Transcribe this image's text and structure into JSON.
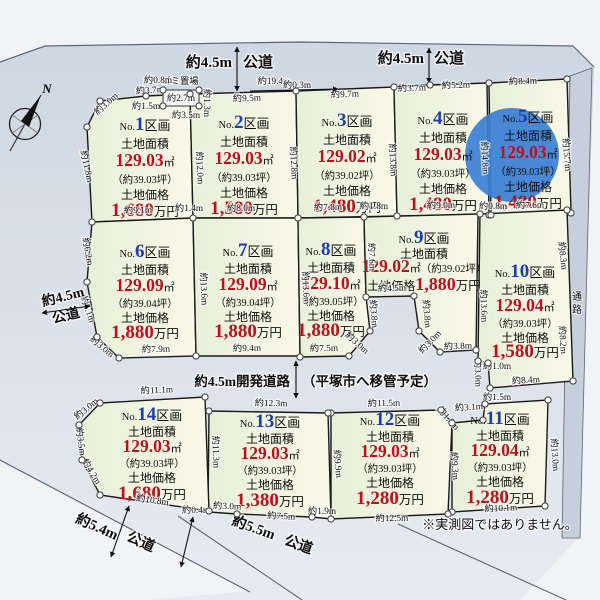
{
  "title": "分譲地区画図",
  "note": "※実測図ではありません。",
  "passage_label": "通路",
  "compass_label": "N",
  "garbage": {
    "label": "ゴミ置場",
    "box": [
      163,
      90,
      36,
      16
    ]
  },
  "colors": {
    "num_blue": "#1d3cb2",
    "price_red": "#bb101e",
    "ink": "#0f0f0f",
    "plot_fill_a": "#e7f0d8",
    "plot_fill_b": "#f9f8e7",
    "plot_stroke": "#1a1a1a",
    "road_a": "#ccd5e1",
    "road_b": "#e7ebf1",
    "outside": "#f1f3f6",
    "strip": "#c6cfdb",
    "line": "#5c6673",
    "dot_stroke": "#4a4a4a",
    "highlight": "#3b7fd4"
  },
  "shared": {
    "no_prefix": "No.",
    "kukaku": "区画",
    "area_label": "土地面積",
    "sqm": "㎡",
    "price_label": "土地価格",
    "price_unit": "万円"
  },
  "plots": [
    {
      "id": 1,
      "no": "1",
      "area": "129.03",
      "tsubo": "（約39.03坪）",
      "price": "1,680",
      "cx": 145,
      "ty": 130,
      "dys": [
        0,
        18,
        36,
        53,
        69,
        86
      ],
      "poly": [
        [
          100,
          101
        ],
        [
          146,
          96
        ],
        [
          190,
          94
        ],
        [
          193,
          218
        ],
        [
          92,
          222
        ],
        [
          87,
          127
        ]
      ]
    },
    {
      "id": 2,
      "no": "2",
      "area": "129.03",
      "tsubo": "（約39.03坪）",
      "price": "1,580",
      "cx": 244,
      "ty": 128,
      "dys": [
        0,
        18,
        36,
        53,
        69,
        86
      ],
      "poly": [
        [
          190,
          94
        ],
        [
          296,
          91
        ],
        [
          298,
          218
        ],
        [
          193,
          218
        ]
      ]
    },
    {
      "id": 3,
      "no": "3",
      "area": "129.02",
      "tsubo": "（約39.02坪）",
      "price": "1,480",
      "cx": 347,
      "ty": 126,
      "dys": [
        0,
        18,
        36,
        53,
        69,
        86
      ],
      "poly": [
        [
          296,
          91
        ],
        [
          394,
          87
        ],
        [
          397,
          216
        ],
        [
          298,
          218
        ]
      ]
    },
    {
      "id": 4,
      "no": "4",
      "area": "129.03",
      "tsubo": "（約39.03坪）",
      "price": "1,480",
      "cx": 443,
      "ty": 124,
      "dys": [
        0,
        18,
        36,
        53,
        69,
        86
      ],
      "poly": [
        [
          394,
          87
        ],
        [
          430,
          85
        ],
        [
          487,
          83
        ],
        [
          489,
          215
        ],
        [
          397,
          216
        ]
      ]
    },
    {
      "id": 5,
      "no": "5",
      "area": "129.03",
      "tsubo": "（約39.03坪）",
      "price": "1,480",
      "cx": 528,
      "ty": 122,
      "dys": [
        0,
        18,
        36,
        53,
        69,
        86
      ],
      "poly": [
        [
          489,
          83
        ],
        [
          567,
          79
        ],
        [
          571,
          213
        ],
        [
          491,
          215
        ]
      ],
      "circle": [
        512,
        155,
        47
      ]
    },
    {
      "id": 6,
      "no": "6",
      "area": "129.09",
      "tsubo": "（約39.04坪）",
      "price": "1,880",
      "cx": 145,
      "ty": 257,
      "dys": [
        0,
        17,
        34,
        50,
        65,
        81
      ],
      "poly": [
        [
          92,
          222
        ],
        [
          193,
          218
        ],
        [
          196,
          356
        ],
        [
          119,
          358
        ],
        [
          97,
          337
        ],
        [
          87,
          282
        ]
      ]
    },
    {
      "id": 7,
      "no": "7",
      "area": "129.09",
      "tsubo": "（約39.04坪）",
      "price": "1,880",
      "cx": 248,
      "ty": 256,
      "dys": [
        0,
        17,
        34,
        50,
        65,
        81
      ],
      "poly": [
        [
          193,
          218
        ],
        [
          298,
          218
        ],
        [
          300,
          356
        ],
        [
          196,
          356
        ]
      ]
    },
    {
      "id": 8,
      "no": "8",
      "area": "129.10",
      "tsubo": "（約39.05坪）",
      "price": "1,880",
      "cx": 331,
      "ty": 255,
      "dys": [
        0,
        17,
        34,
        50,
        65,
        81
      ],
      "poly": [
        [
          298,
          218
        ],
        [
          364,
          217
        ],
        [
          366,
          297
        ],
        [
          370,
          331
        ],
        [
          349,
          356
        ],
        [
          300,
          357
        ]
      ]
    },
    {
      "id": 9,
      "no": "9",
      "area": "129.02",
      "tsubo": "（約39.02坪）",
      "price": "1,880",
      "cx": 424,
      "ty": 243,
      "dys": [
        0,
        15,
        29,
        47
      ],
      "wide": true,
      "poly": [
        [
          364,
          217
        ],
        [
          478,
          214
        ],
        [
          476,
          350
        ],
        [
          440,
          352
        ],
        [
          419,
          331
        ],
        [
          414,
          296
        ],
        [
          366,
          297
        ]
      ]
    },
    {
      "id": 10,
      "no": "10",
      "area": "129.04",
      "tsubo": "（約39.03坪）",
      "price": "1,580",
      "cx": 525,
      "ty": 277,
      "dys": [
        0,
        17,
        34,
        50,
        65,
        80
      ],
      "poly": [
        [
          480,
          214
        ],
        [
          567,
          210
        ],
        [
          573,
          381
        ],
        [
          490,
          388
        ],
        [
          488,
          363
        ],
        [
          478,
          361
        ]
      ]
    },
    {
      "id": 11,
      "no": "11",
      "area": "129.04",
      "tsubo": "（約39.03坪）",
      "price": "1,280",
      "cx": 500,
      "ty": 424,
      "dys": [
        0,
        16,
        32,
        47,
        62,
        79
      ],
      "poly": [
        [
          452,
          423
        ],
        [
          483,
          420
        ],
        [
          485,
          404
        ],
        [
          548,
          400
        ],
        [
          545,
          506
        ],
        [
          452,
          512
        ]
      ]
    },
    {
      "id": 12,
      "no": "12",
      "area": "129.03",
      "tsubo": "（約39.03坪）",
      "price": "1,280",
      "cx": 390,
      "ty": 425,
      "dys": [
        0,
        16,
        32,
        47,
        62,
        79
      ],
      "poly": [
        [
          331,
          413
        ],
        [
          441,
          410
        ],
        [
          452,
          423
        ],
        [
          448,
          514
        ],
        [
          331,
          519
        ]
      ]
    },
    {
      "id": 13,
      "no": "13",
      "area": "129.03",
      "tsubo": "（約39.03坪）",
      "price": "1,380",
      "cx": 270,
      "ty": 427,
      "dys": [
        0,
        16,
        32,
        47,
        62,
        79
      ],
      "poly": [
        [
          209,
          411
        ],
        [
          328,
          413
        ],
        [
          331,
          519
        ],
        [
          312,
          517
        ],
        [
          237,
          514
        ],
        [
          208,
          512
        ]
      ]
    },
    {
      "id": 14,
      "no": "14",
      "area": "129.03",
      "tsubo": "（約39.03坪）",
      "price": "1,680",
      "cx": 152,
      "ty": 420,
      "dys": [
        0,
        16,
        32,
        47,
        62,
        79
      ],
      "poly": [
        [
          100,
          403
        ],
        [
          205,
          397
        ],
        [
          209,
          511
        ],
        [
          100,
          495
        ],
        [
          82,
          460
        ],
        [
          79,
          425
        ]
      ]
    }
  ],
  "dims": [
    {
      "t": "約0.8m",
      "x": 158,
      "y": 83,
      "r": 0
    },
    {
      "t": "約19.4m",
      "x": 274,
      "y": 84,
      "r": 0
    },
    {
      "t": "約2.7m",
      "x": 181,
      "y": 101,
      "r": 0
    },
    {
      "t": "約3.5m",
      "x": 186,
      "y": 118,
      "r": 0
    },
    {
      "t": "約1.3m",
      "x": 204,
      "y": 103,
      "r": 90
    },
    {
      "t": "約3.0m",
      "x": 108,
      "y": 106,
      "r": -42
    },
    {
      "t": "約3.7m",
      "x": 150,
      "y": 93,
      "r": -4
    },
    {
      "t": "約1.5m",
      "x": 146,
      "y": 109,
      "r": 0
    },
    {
      "t": "約9.5m",
      "x": 247,
      "y": 101,
      "r": -2
    },
    {
      "t": "約0.3m",
      "x": 297,
      "y": 88,
      "r": 0
    },
    {
      "t": "約9.7m",
      "x": 345,
      "y": 97,
      "r": -2
    },
    {
      "t": "約3.7m",
      "x": 412,
      "y": 91,
      "r": -2
    },
    {
      "t": "約5.2m",
      "x": 456,
      "y": 88,
      "r": -2
    },
    {
      "t": "約8.4m",
      "x": 523,
      "y": 84,
      "r": -2
    },
    {
      "t": "約11.8m",
      "x": 84,
      "y": 167,
      "r": 78
    },
    {
      "t": "約12.0m",
      "x": 197,
      "y": 168,
      "r": 87
    },
    {
      "t": "約12.8m",
      "x": 291,
      "y": 163,
      "r": 87
    },
    {
      "t": "約13.8m",
      "x": 390,
      "y": 160,
      "r": 87
    },
    {
      "t": "約14.8m",
      "x": 482,
      "y": 158,
      "r": 87
    },
    {
      "t": "約15.7m",
      "x": 564,
      "y": 155,
      "r": 85
    },
    {
      "t": "約9.1m",
      "x": 138,
      "y": 213,
      "r": -1
    },
    {
      "t": "約1.4m",
      "x": 189,
      "y": 211,
      "r": 0
    },
    {
      "t": "約8.0m",
      "x": 241,
      "y": 211,
      "r": 0
    },
    {
      "t": "約7.8m",
      "x": 328,
      "y": 210,
      "r": -1
    },
    {
      "t": "約1.8m",
      "x": 374,
      "y": 209,
      "r": 0
    },
    {
      "t": "約9.0m",
      "x": 441,
      "y": 208,
      "r": -1
    },
    {
      "t": "約0.8m",
      "x": 493,
      "y": 209,
      "r": 0
    },
    {
      "t": "約7.6m",
      "x": 530,
      "y": 208,
      "r": -1
    },
    {
      "t": "約6.2m",
      "x": 85,
      "y": 252,
      "r": 80
    },
    {
      "t": "約5.1m",
      "x": 85,
      "y": 310,
      "r": 70
    },
    {
      "t": "約3.0m",
      "x": 100,
      "y": 349,
      "r": 40
    },
    {
      "t": "約13.6m",
      "x": 201,
      "y": 289,
      "r": 87
    },
    {
      "t": "約13.6m",
      "x": 303,
      "y": 288,
      "r": 87
    },
    {
      "t": "約7.6m",
      "x": 369,
      "y": 257,
      "r": 87
    },
    {
      "t": "約3.8m",
      "x": 371,
      "y": 314,
      "r": 85
    },
    {
      "t": "約3.0m",
      "x": 355,
      "y": 345,
      "r": 42
    },
    {
      "t": "約4.5m",
      "x": 392,
      "y": 291,
      "r": -1
    },
    {
      "t": "約3.8m",
      "x": 424,
      "y": 314,
      "r": 85
    },
    {
      "t": "約3.0m",
      "x": 432,
      "y": 344,
      "r": -46
    },
    {
      "t": "約3.8m",
      "x": 458,
      "y": 349,
      "r": -2
    },
    {
      "t": "約13.6m",
      "x": 481,
      "y": 306,
      "r": 88
    },
    {
      "t": "約3.0m",
      "x": 475,
      "y": 373,
      "r": 88
    },
    {
      "t": "約1.0m",
      "x": 497,
      "y": 369,
      "r": 0
    },
    {
      "t": "約8.3m",
      "x": 560,
      "y": 256,
      "r": 84
    },
    {
      "t": "約8.2m",
      "x": 560,
      "y": 340,
      "r": 86
    },
    {
      "t": "約7.9m",
      "x": 156,
      "y": 352,
      "r": -1
    },
    {
      "t": "約9.4m",
      "x": 247,
      "y": 351,
      "r": -1
    },
    {
      "t": "約7.5m",
      "x": 324,
      "y": 351,
      "r": -1
    },
    {
      "t": "約8.4m",
      "x": 526,
      "y": 383,
      "r": -4
    },
    {
      "t": "約1.5m",
      "x": 497,
      "y": 400,
      "r": 0
    },
    {
      "t": "約3.1m",
      "x": 469,
      "y": 410,
      "r": -4
    },
    {
      "t": "約1.8m",
      "x": 446,
      "y": 420,
      "r": 48
    },
    {
      "t": "約11.1m",
      "x": 157,
      "y": 393,
      "r": -3
    },
    {
      "t": "約12.3m",
      "x": 271,
      "y": 406,
      "r": 1
    },
    {
      "t": "約11.5m",
      "x": 384,
      "y": 406,
      "r": -1
    },
    {
      "t": "約3.0m",
      "x": 88,
      "y": 411,
      "r": -40
    },
    {
      "t": "約3.5m",
      "x": 78,
      "y": 442,
      "r": 82
    },
    {
      "t": "約4.2m",
      "x": 89,
      "y": 473,
      "r": 58
    },
    {
      "t": "約11.3m",
      "x": 213,
      "y": 452,
      "r": 88
    },
    {
      "t": "約9.9m",
      "x": 335,
      "y": 464,
      "r": 85
    },
    {
      "t": "約9.3m",
      "x": 452,
      "y": 466,
      "r": 86
    },
    {
      "t": "約13.0m",
      "x": 552,
      "y": 455,
      "r": 86
    },
    {
      "t": "約10.8m",
      "x": 152,
      "y": 503,
      "r": 8
    },
    {
      "t": "約0.4m",
      "x": 196,
      "y": 513,
      "r": 0
    },
    {
      "t": "約3.0m",
      "x": 227,
      "y": 509,
      "r": 2
    },
    {
      "t": "約7.5m",
      "x": 281,
      "y": 519,
      "r": 3
    },
    {
      "t": "約1.9m",
      "x": 322,
      "y": 514,
      "r": 0
    },
    {
      "t": "約12.5m",
      "x": 392,
      "y": 521,
      "r": -1
    },
    {
      "t": "約10.1m",
      "x": 501,
      "y": 511,
      "r": -3
    }
  ],
  "road_labels": [
    {
      "t": "約4.5m",
      "x": 232,
      "y": 67,
      "anchor": "end",
      "s": 15
    },
    {
      "t": "公道",
      "x": 243,
      "y": 67,
      "anchor": "start",
      "s": 15
    },
    {
      "t": "約4.5m",
      "x": 424,
      "y": 63,
      "anchor": "end",
      "s": 15
    },
    {
      "t": "公道",
      "x": 434,
      "y": 63,
      "anchor": "start",
      "s": 15
    },
    {
      "t": "約4.5m",
      "x": 64,
      "y": 301,
      "r": -14,
      "s": 14
    },
    {
      "t": "公道",
      "x": 67,
      "y": 320,
      "r": -14,
      "s": 14
    },
    {
      "t": "約4.5m開発道路",
      "x": 290,
      "y": 386,
      "anchor": "end",
      "s": 13.5
    },
    {
      "t": "（平塚市へ移管予定）",
      "x": 302,
      "y": 386,
      "anchor": "start",
      "s": 13.5
    },
    {
      "t": "約5.4m",
      "x": 95,
      "y": 531,
      "r": 24,
      "s": 14.5
    },
    {
      "t": "公道",
      "x": 139,
      "y": 546,
      "r": 24,
      "s": 14.5
    },
    {
      "t": "約5.5m",
      "x": 252,
      "y": 532,
      "r": 20,
      "s": 14.5
    },
    {
      "t": "公道",
      "x": 297,
      "y": 549,
      "r": 20,
      "s": 14.5
    }
  ],
  "arrows": [
    {
      "x1": 237,
      "y1": 47,
      "x2": 237,
      "y2": 91,
      "both": true
    },
    {
      "x1": 429,
      "y1": 48,
      "x2": 429,
      "y2": 83,
      "both": true
    },
    {
      "x1": 42,
      "y1": 313,
      "x2": 90,
      "y2": 306,
      "both": true
    },
    {
      "x1": 296,
      "y1": 361,
      "x2": 296,
      "y2": 398,
      "both": true
    },
    {
      "x1": 129,
      "y1": 506,
      "x2": 111,
      "y2": 557,
      "both": true
    },
    {
      "x1": 193,
      "y1": 517,
      "x2": 181,
      "y2": 567,
      "both": true
    },
    {
      "x1": 250,
      "y1": 91,
      "x2": 338,
      "y2": 89,
      "both": false
    }
  ],
  "geometry": {
    "outside_top": "0,0 600,0 600,62 594,67 573,46 300,42 45,46 0,62",
    "outside_right": "594,67 600,62 600,600 520,600 578,538",
    "outside_bottom_left": "0,462 248,591 150,600 0,600",
    "strip": "570,76 592,68 580,538 562,538 566,300",
    "top_boundary": "0,62 45,46 300,42 573,46 594,67",
    "road_lines": [
      [
        0,
        460,
        250,
        592
      ],
      [
        178,
        516,
        302,
        600
      ],
      [
        398,
        524,
        566,
        600
      ]
    ],
    "note_pos": [
      500,
      529
    ],
    "passage_pos": [
      577,
      300
    ],
    "compass": {
      "cx": 25,
      "cy": 124,
      "r": 15.5,
      "n_pos": [
        47,
        93
      ]
    }
  }
}
